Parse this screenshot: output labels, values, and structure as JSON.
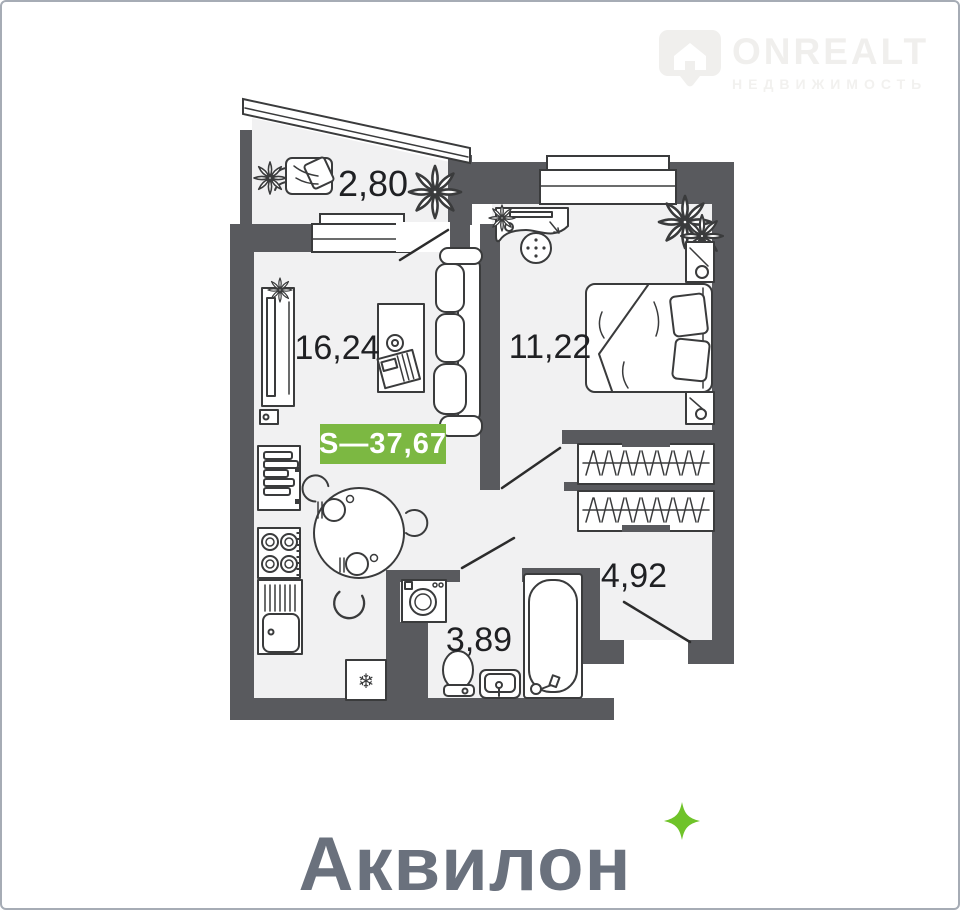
{
  "header": {
    "logo": {
      "brand": "ONREALT",
      "tagline": "НЕДВИЖИМОСТЬ"
    }
  },
  "plan": {
    "total_area_badge": "S—37,67",
    "rooms": [
      {
        "name": "balcony",
        "area": "2,80"
      },
      {
        "name": "living-kitchen",
        "area": "16,24"
      },
      {
        "name": "bedroom",
        "area": "11,22"
      },
      {
        "name": "hallway",
        "area": "4,92"
      },
      {
        "name": "bathroom",
        "area": "3,89"
      }
    ],
    "icons": {
      "fridge_snowflake": "❄"
    }
  },
  "footer": {
    "brand": "Аквилон"
  },
  "colors": {
    "wall": "#595a5e",
    "floor": "#f1f1f2",
    "badge_green": "#7cb842",
    "brand_gray": "#6a717d",
    "sparkle_green": "#6fc329",
    "watermark_gray": "#f0efed"
  }
}
